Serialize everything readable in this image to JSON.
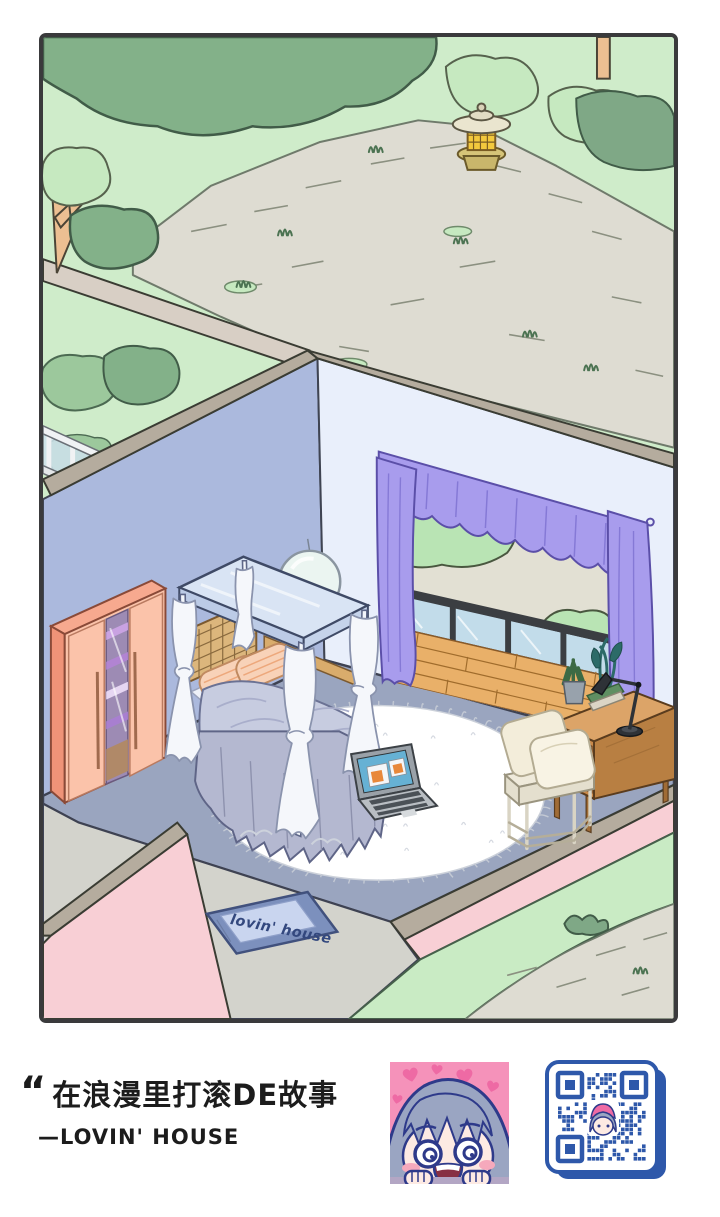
{
  "artwork": {
    "type": "illustration",
    "description": "Isometric cutaway illustration of a cozy bedroom opening onto a balcony, surrounded by a garden with a stone path and a stone lantern",
    "frame_color": "#3a3a3c"
  },
  "scene": {
    "doormat_text": "lovin' house",
    "palette": {
      "grass": "#cfecca",
      "bush_dark": "#83b189",
      "stone_path": "#dedcd2",
      "wall_top_band": "#b5ac9e",
      "left_wall": "#abb9dd",
      "back_wall": "#e9effb",
      "floor": "#9aa5bf",
      "exterior_pink": "#f8cfd5",
      "walkway": "#d3d3cc",
      "curtain_purple": "#a89ced",
      "wardrobe_salmon": "#fbc3aa",
      "canopy_blue": "#d9e4f4",
      "duvet": "#c7cce0",
      "pillow_peach": "#f8d2b8",
      "rug": "#ffffff",
      "lantern_glow": "#f3c93d",
      "balcony_wood": "#e9b069",
      "desk_wood": "#dca468",
      "laptop_screen": "#66b1d4",
      "doormat_blue": "#7c90bd",
      "qr_blue": "#2e58aa",
      "avatar_pink": "#f592ba"
    }
  },
  "caption": {
    "quote_mark": "“",
    "quote_text": "在浪漫里打滚DE故事",
    "attribution": "—LOVIN' HOUSE"
  }
}
